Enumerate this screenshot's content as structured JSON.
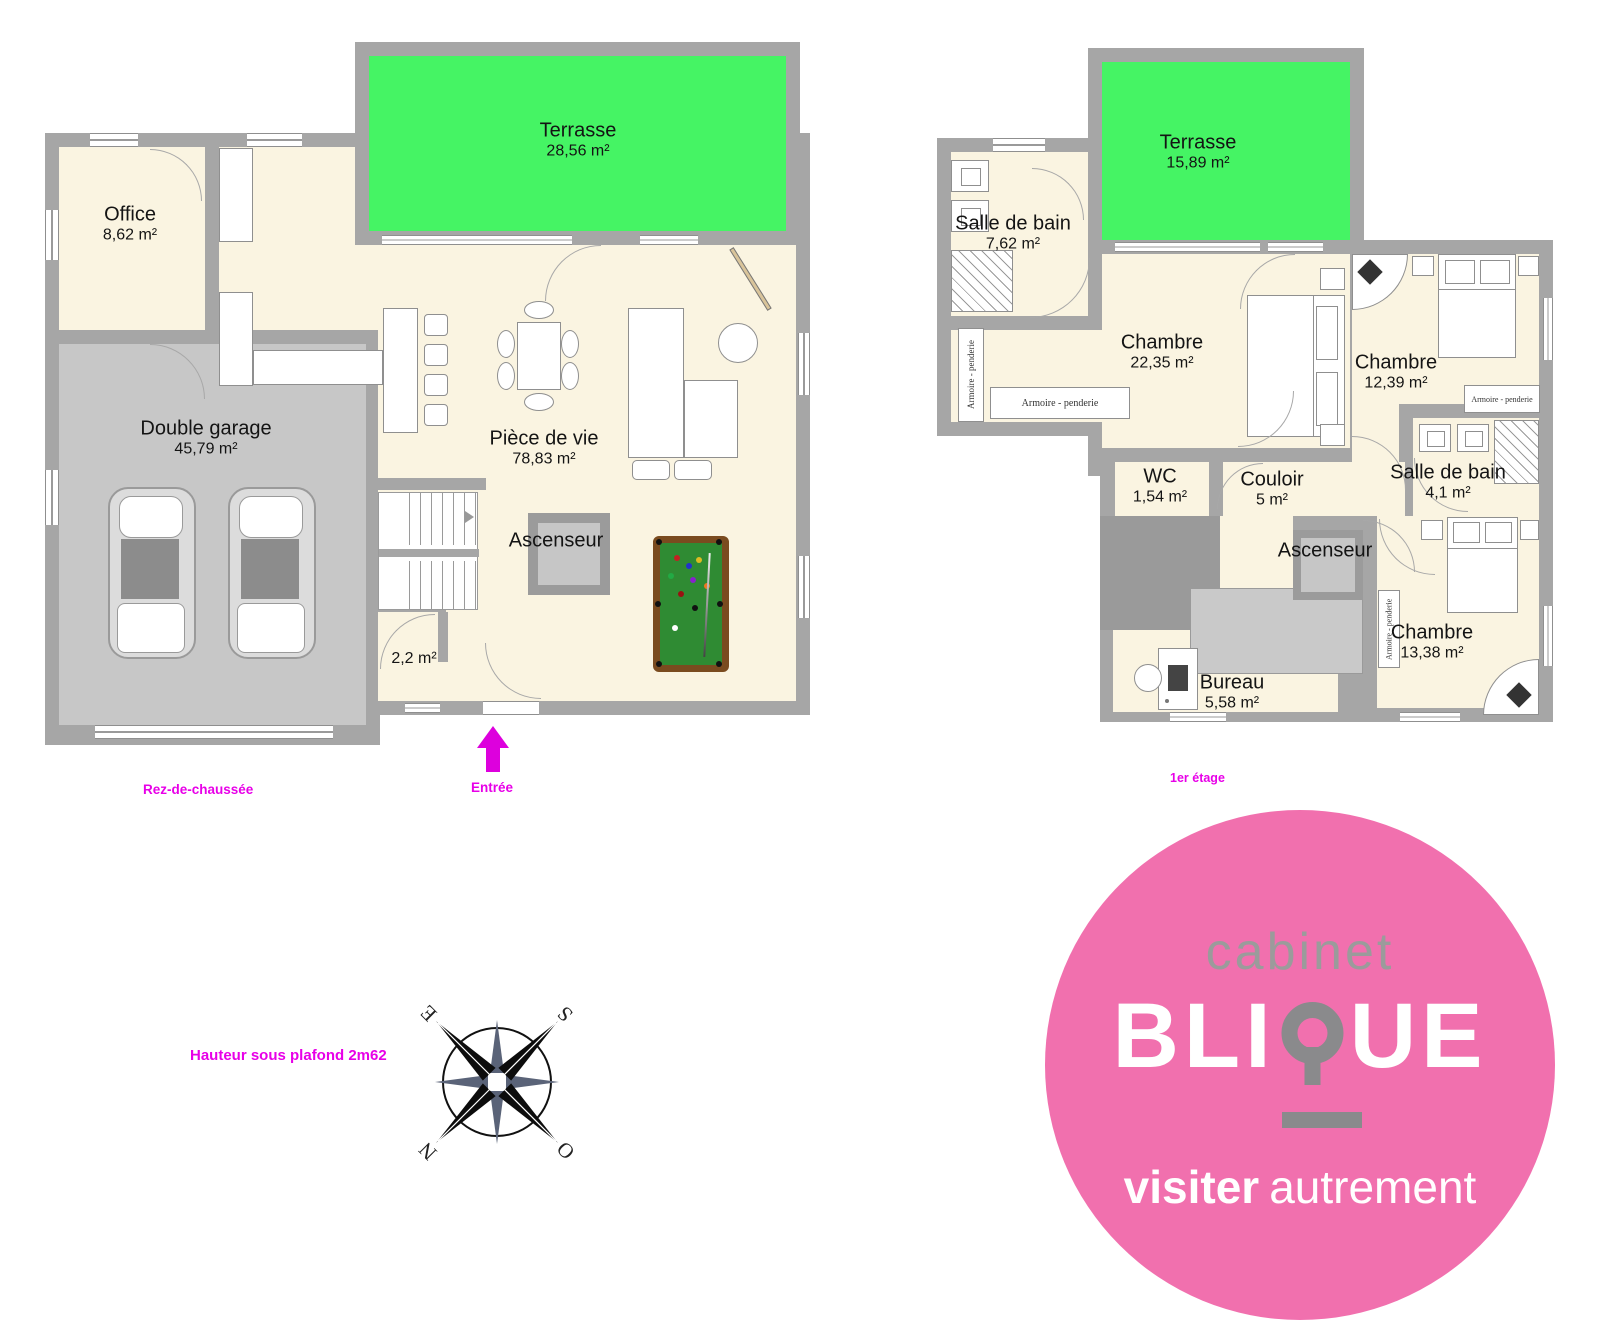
{
  "rdc": {
    "caption": "Rez-de-chaussée",
    "entrance": "Entrée",
    "rooms": {
      "terrasse": {
        "name": "Terrasse",
        "area": "28,56 m²"
      },
      "office": {
        "name": "Office",
        "area": "8,62 m²"
      },
      "garage": {
        "name": "Double garage",
        "area": "45,79 m²"
      },
      "piece_de_vie": {
        "name": "Pièce de vie",
        "area": "78,83 m²"
      },
      "ascenseur": {
        "name": "Ascenseur"
      },
      "entry_hall": {
        "area": "2,2 m²"
      }
    }
  },
  "etage1": {
    "caption": "1er étage",
    "wardrobe_label": "Armoire - penderie",
    "rooms": {
      "terrasse": {
        "name": "Terrasse",
        "area": "15,89 m²"
      },
      "salle_de_bain_grande": {
        "name": "Salle de bain",
        "area": "7,62 m²"
      },
      "chambre_principale": {
        "name": "Chambre",
        "area": "22,35 m²"
      },
      "chambre_2": {
        "name": "Chambre",
        "area": "12,39 m²"
      },
      "wc": {
        "name": "WC",
        "area": "1,54 m²"
      },
      "couloir": {
        "name": "Couloir",
        "area": "5 m²"
      },
      "salle_de_bain_petite": {
        "name": "Salle de bain",
        "area": "4,1 m²"
      },
      "ascenseur": {
        "name": "Ascenseur"
      },
      "bureau": {
        "name": "Bureau",
        "area": "5,58 m²"
      },
      "chambre_3": {
        "name": "Chambre",
        "area": "13,38 m²"
      }
    }
  },
  "notes": {
    "ceiling_height": "Hauteur sous plafond 2m62"
  },
  "compass": {
    "n": "N",
    "s": "S",
    "e": "E",
    "o": "O"
  },
  "logo": {
    "top": "cabinet",
    "brand_prefix": "BLI",
    "brand_suffix": "UE",
    "tagline_bold": "visiter",
    "tagline_regular": "autrement"
  },
  "colors": {
    "terrace_green": "#45F464",
    "wall_gray": "#A6A6A6",
    "floor_cream": "#FAF4E1",
    "garage_gray": "#C7C7C7",
    "accent_magenta": "#E800E8",
    "logo_pink": "#F170AE",
    "billiard_green": "#2F8B33"
  }
}
